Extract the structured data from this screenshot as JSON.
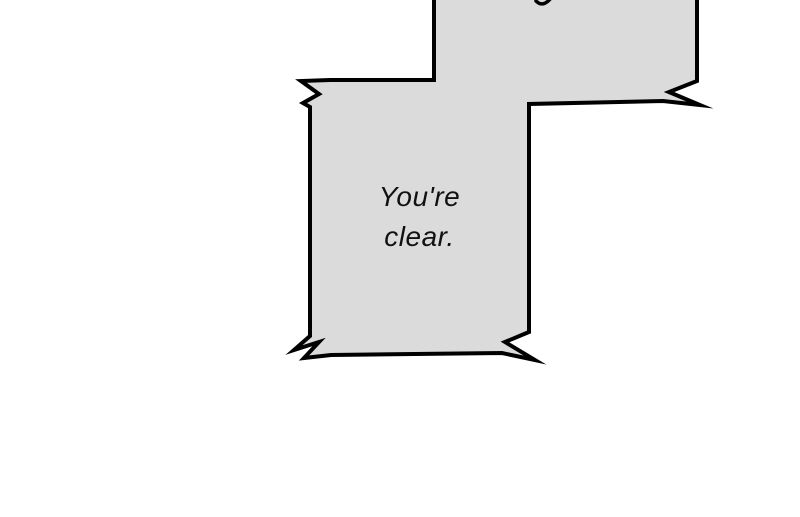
{
  "panel": {
    "type": "comic-panel",
    "background_color": "#ffffff"
  },
  "speech_bubble": {
    "text": "You're\nclear.",
    "style": "jagged-corner rectangular shout bubble",
    "fill_color": "#dbdbdb",
    "border_color": "#000000",
    "text_color": "#111111"
  },
  "top_bubble": {
    "description": "partially visible bubble cut off by top edge, connected to main bubble, shows only a descender stroke of a cut-off letter",
    "fill_color": "#dbdbdb",
    "border_color": "#000000"
  },
  "colors": {
    "background": "#ffffff",
    "bubble_fill": "#dbdbdb",
    "bubble_border": "#000000",
    "text": "#111111"
  }
}
